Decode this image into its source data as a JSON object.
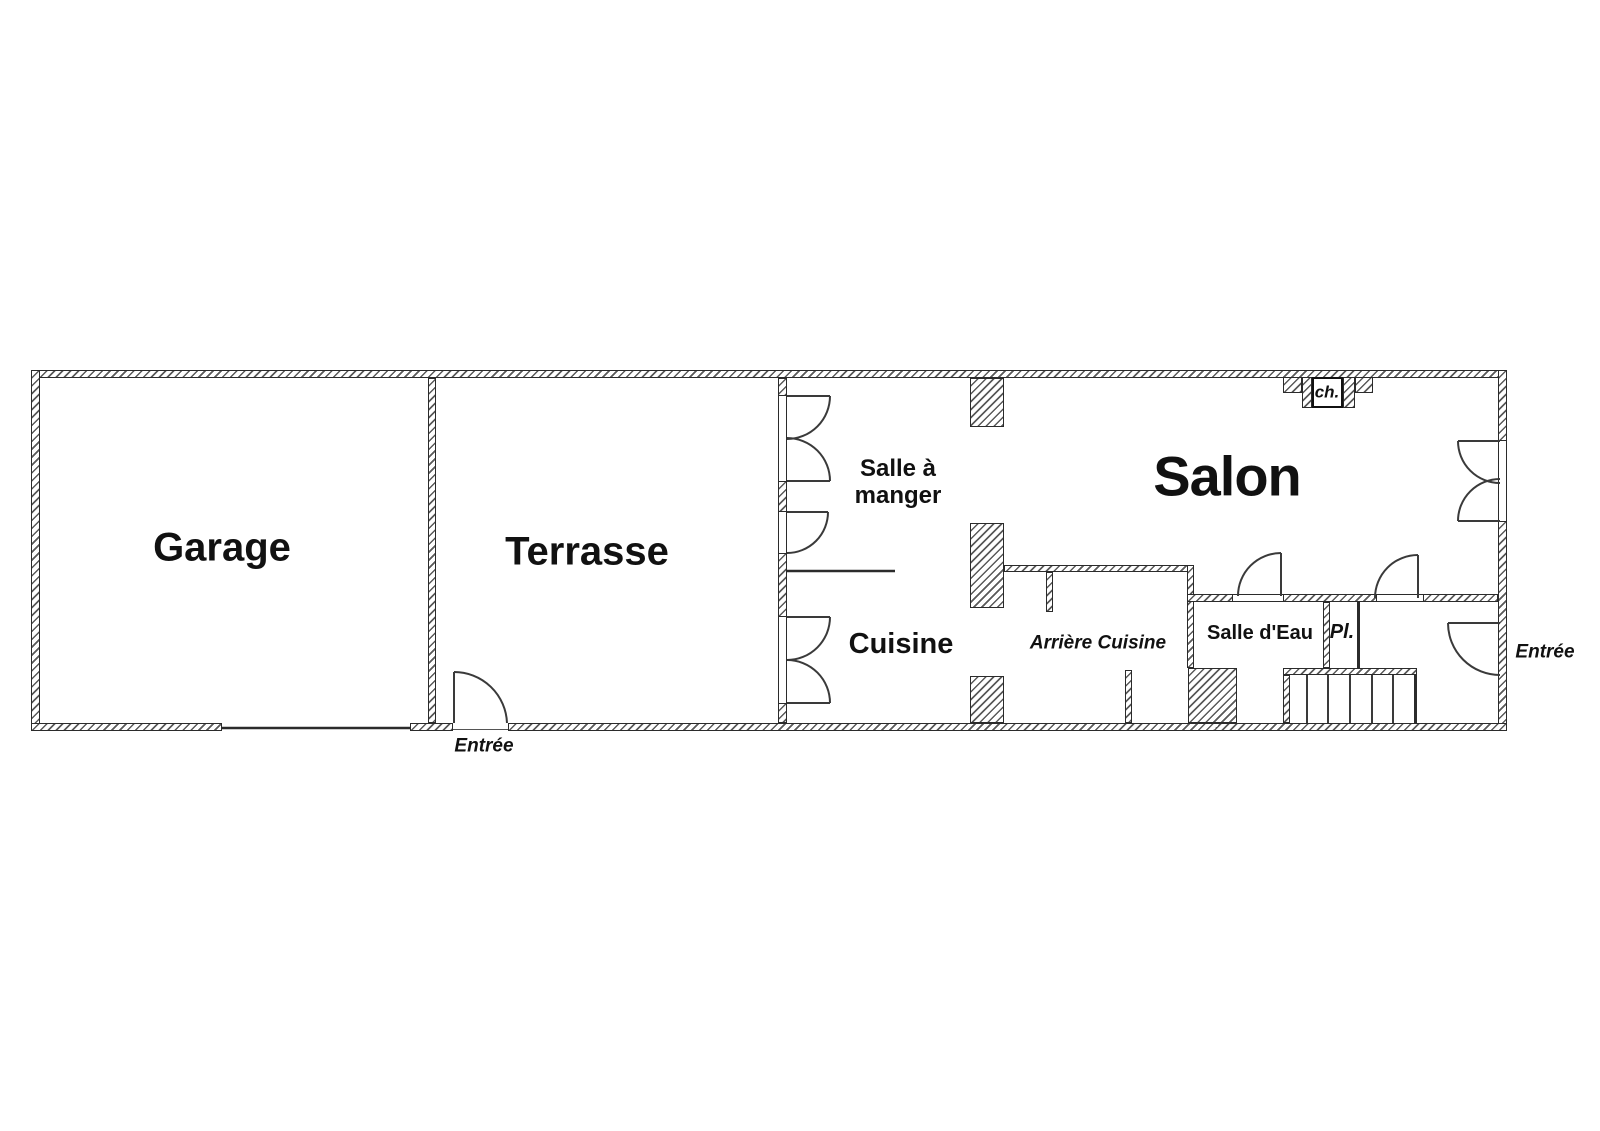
{
  "rooms": {
    "garage": {
      "label": "Garage"
    },
    "terrasse": {
      "label": "Terrasse"
    },
    "salle_a_manger": {
      "label": "Salle à\nmanger"
    },
    "cuisine": {
      "label": "Cuisine"
    },
    "arriere_cuisine": {
      "label": "Arrière Cuisine"
    },
    "salon": {
      "label": "Salon"
    },
    "salle_d_eau": {
      "label": "Salle d'Eau"
    },
    "placard": {
      "label": "Pl."
    }
  },
  "annotations": {
    "chimney": {
      "label": "ch."
    },
    "entree_terrasse": {
      "label": "Entrée"
    },
    "entree_main": {
      "label": "Entrée"
    }
  },
  "colors": {
    "wall_line": "#2b2b2b",
    "hatch": "#5a5a5a",
    "text": "#111111",
    "background": "#ffffff"
  }
}
